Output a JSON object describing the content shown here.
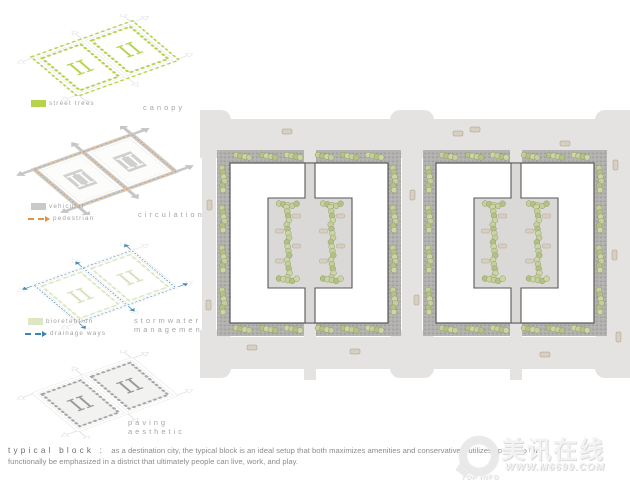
{
  "left_panel": {
    "diagrams": [
      {
        "title": "canopy",
        "subtitle": "",
        "legend": [
          {
            "type": "swatch",
            "color": "#b5d44c",
            "label": "street trees"
          }
        ]
      },
      {
        "title": "circulation",
        "subtitle": "",
        "legend": [
          {
            "type": "swatch",
            "color": "#c9c9c8",
            "label": "vehicular"
          },
          {
            "type": "dashed-arrow",
            "color": "#e8923c",
            "label": "pedestrian"
          }
        ]
      },
      {
        "title": "stormwater",
        "subtitle": "management",
        "legend": [
          {
            "type": "swatch",
            "color": "#dde7c3",
            "label": "bioretention"
          },
          {
            "type": "dashed-arrow",
            "color": "#3a86b6",
            "label": "drainage ways"
          }
        ]
      },
      {
        "title": "paving",
        "subtitle": "aesthetic",
        "legend": []
      }
    ]
  },
  "caption": {
    "heading": "typical block :",
    "line1": "as a destination city, the typical block is an ideal setup that both maximizes amenities and conservatively utilizes space, so that",
    "line2": "functionally be emphasized in a district that ultimately people can live, work, and play."
  },
  "watermark": {
    "name": "美讯在线",
    "tagline": "TOP INFO",
    "url": "WWW.M6699.COM"
  },
  "colors": {
    "street_trees_green": "#b5d44c",
    "pedestrian_orange": "#e8923c",
    "drainage_blue": "#3a86b6",
    "bioretention_green": "#dde7c3",
    "road_gray": "#e4e3e2",
    "sidewalk_gray": "#b2b1af"
  }
}
